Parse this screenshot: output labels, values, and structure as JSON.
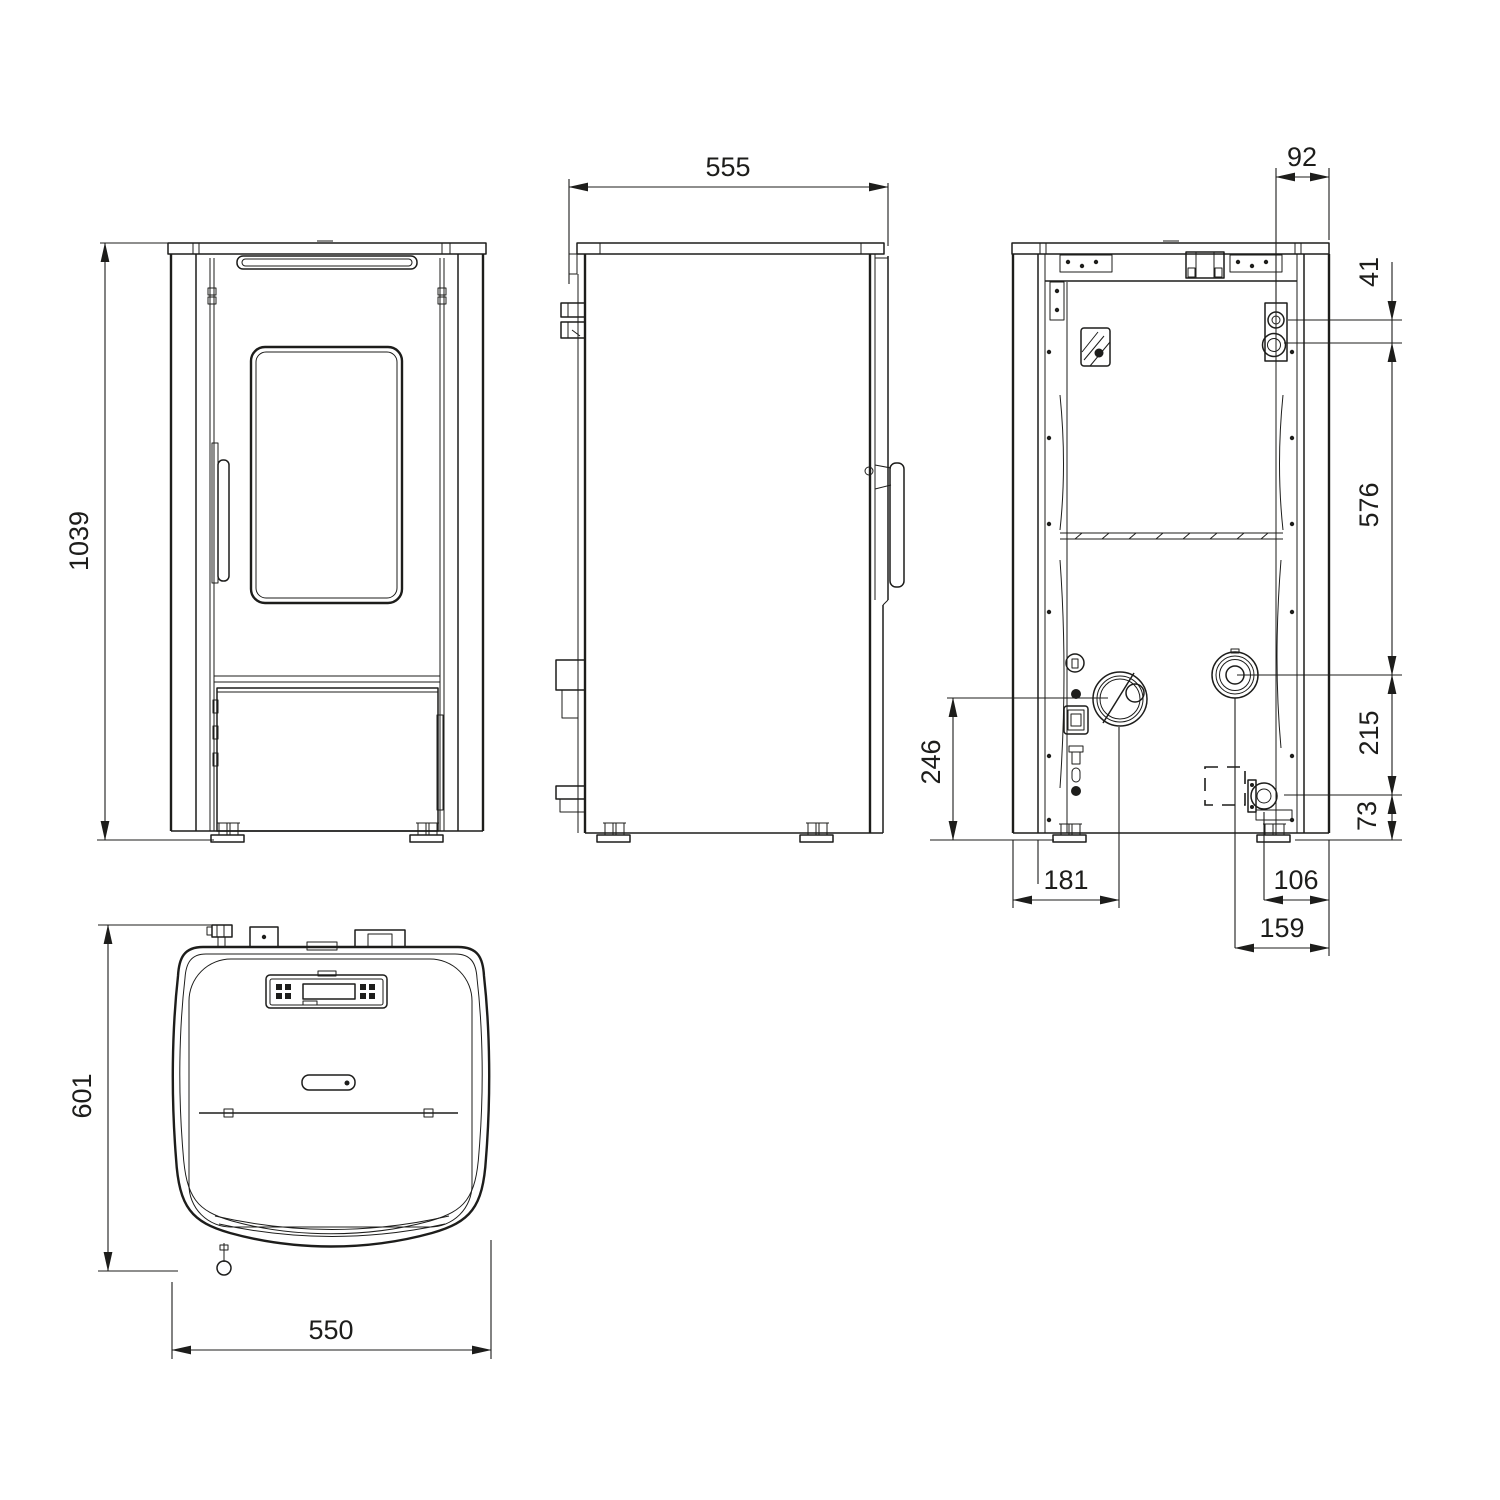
{
  "drawing": {
    "subject": "pellet-stove-dimension-drawing",
    "background_color": "#ffffff",
    "line_color": "#1d1d1b",
    "views": [
      "front-view",
      "side-view",
      "back-view",
      "top-view"
    ]
  },
  "dims": {
    "front_height": "1039",
    "depth": "555",
    "rear_pipe_offset": "92",
    "fitting_spacing": "41",
    "fitting_to_return_span": "576",
    "return_to_drain_span": "215",
    "drain_to_floor": "73",
    "flue_center_height": "246",
    "flue_offset_left": "181",
    "drain_offset_right": "106",
    "return_offset_right": "159",
    "top_depth": "601",
    "top_width": "550"
  }
}
